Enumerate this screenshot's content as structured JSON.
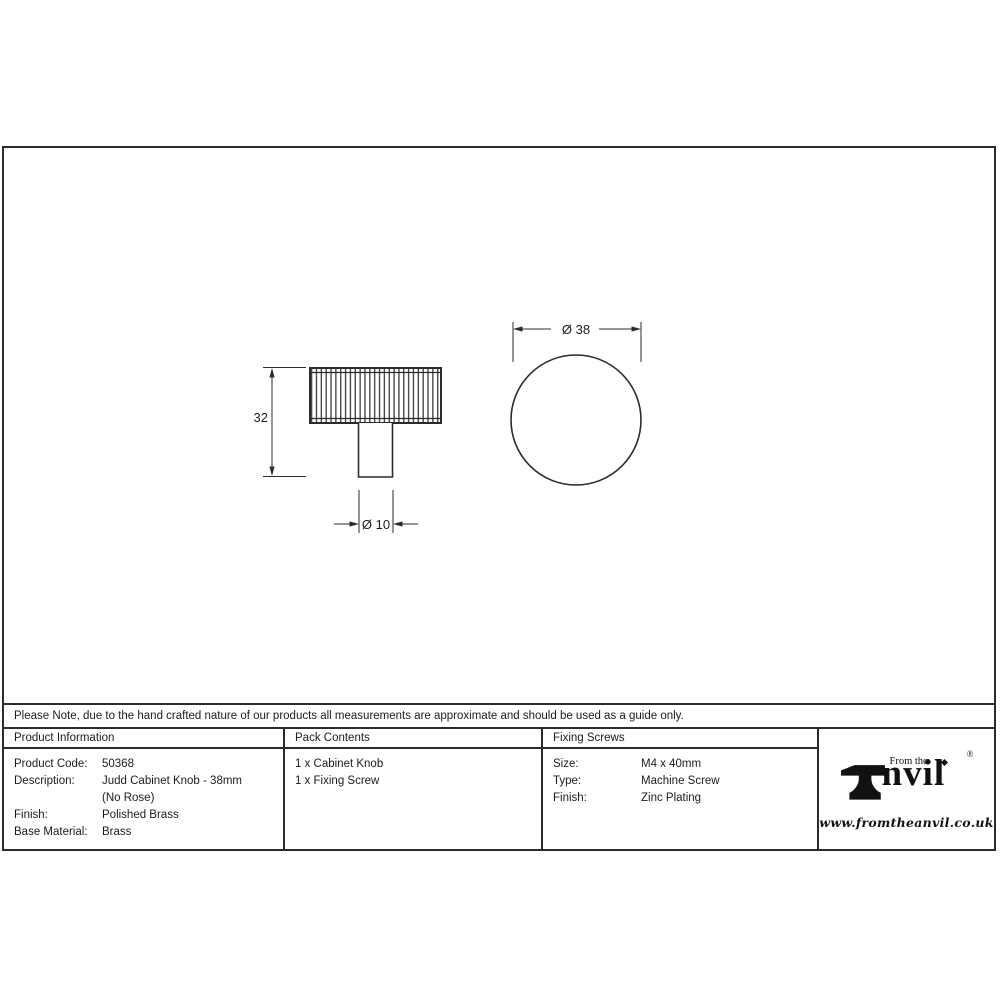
{
  "sheet": {
    "note": "Please Note, due to the hand crafted nature of our products all measurements are approximate and should be used as a guide only."
  },
  "drawing": {
    "side_view": {
      "height_dim": "32",
      "stem_diameter_dim": "Ø 10"
    },
    "front_view": {
      "diameter_dim": "Ø 38"
    }
  },
  "table": {
    "product_information": {
      "header": "Product Information",
      "rows": [
        {
          "label": "Product Code:",
          "value": "50368"
        },
        {
          "label": "Description:",
          "value": "Judd Cabinet Knob - 38mm"
        },
        {
          "label": "",
          "value": "(No Rose)"
        },
        {
          "label": "Finish:",
          "value": "Polished Brass"
        },
        {
          "label": "Base Material:",
          "value": "Brass"
        }
      ]
    },
    "pack_contents": {
      "header": "Pack Contents",
      "items": [
        {
          "value": "1 x Cabinet Knob"
        },
        {
          "value": "1 x Fixing Screw"
        }
      ]
    },
    "fixing_screws": {
      "header": "Fixing Screws",
      "rows": [
        {
          "label": "Size:",
          "value": "M4 x 40mm"
        },
        {
          "label": "Type:",
          "value": "Machine Screw"
        },
        {
          "label": "Finish:",
          "value": "Zinc Plating"
        }
      ]
    }
  },
  "logo": {
    "tagline": "From the",
    "brand_text": "nvil",
    "registered_mark": "®",
    "website": "www.fromtheanvil.co.uk"
  },
  "colors": {
    "line": "#2b2b2b",
    "text": "#1c1c1c"
  }
}
